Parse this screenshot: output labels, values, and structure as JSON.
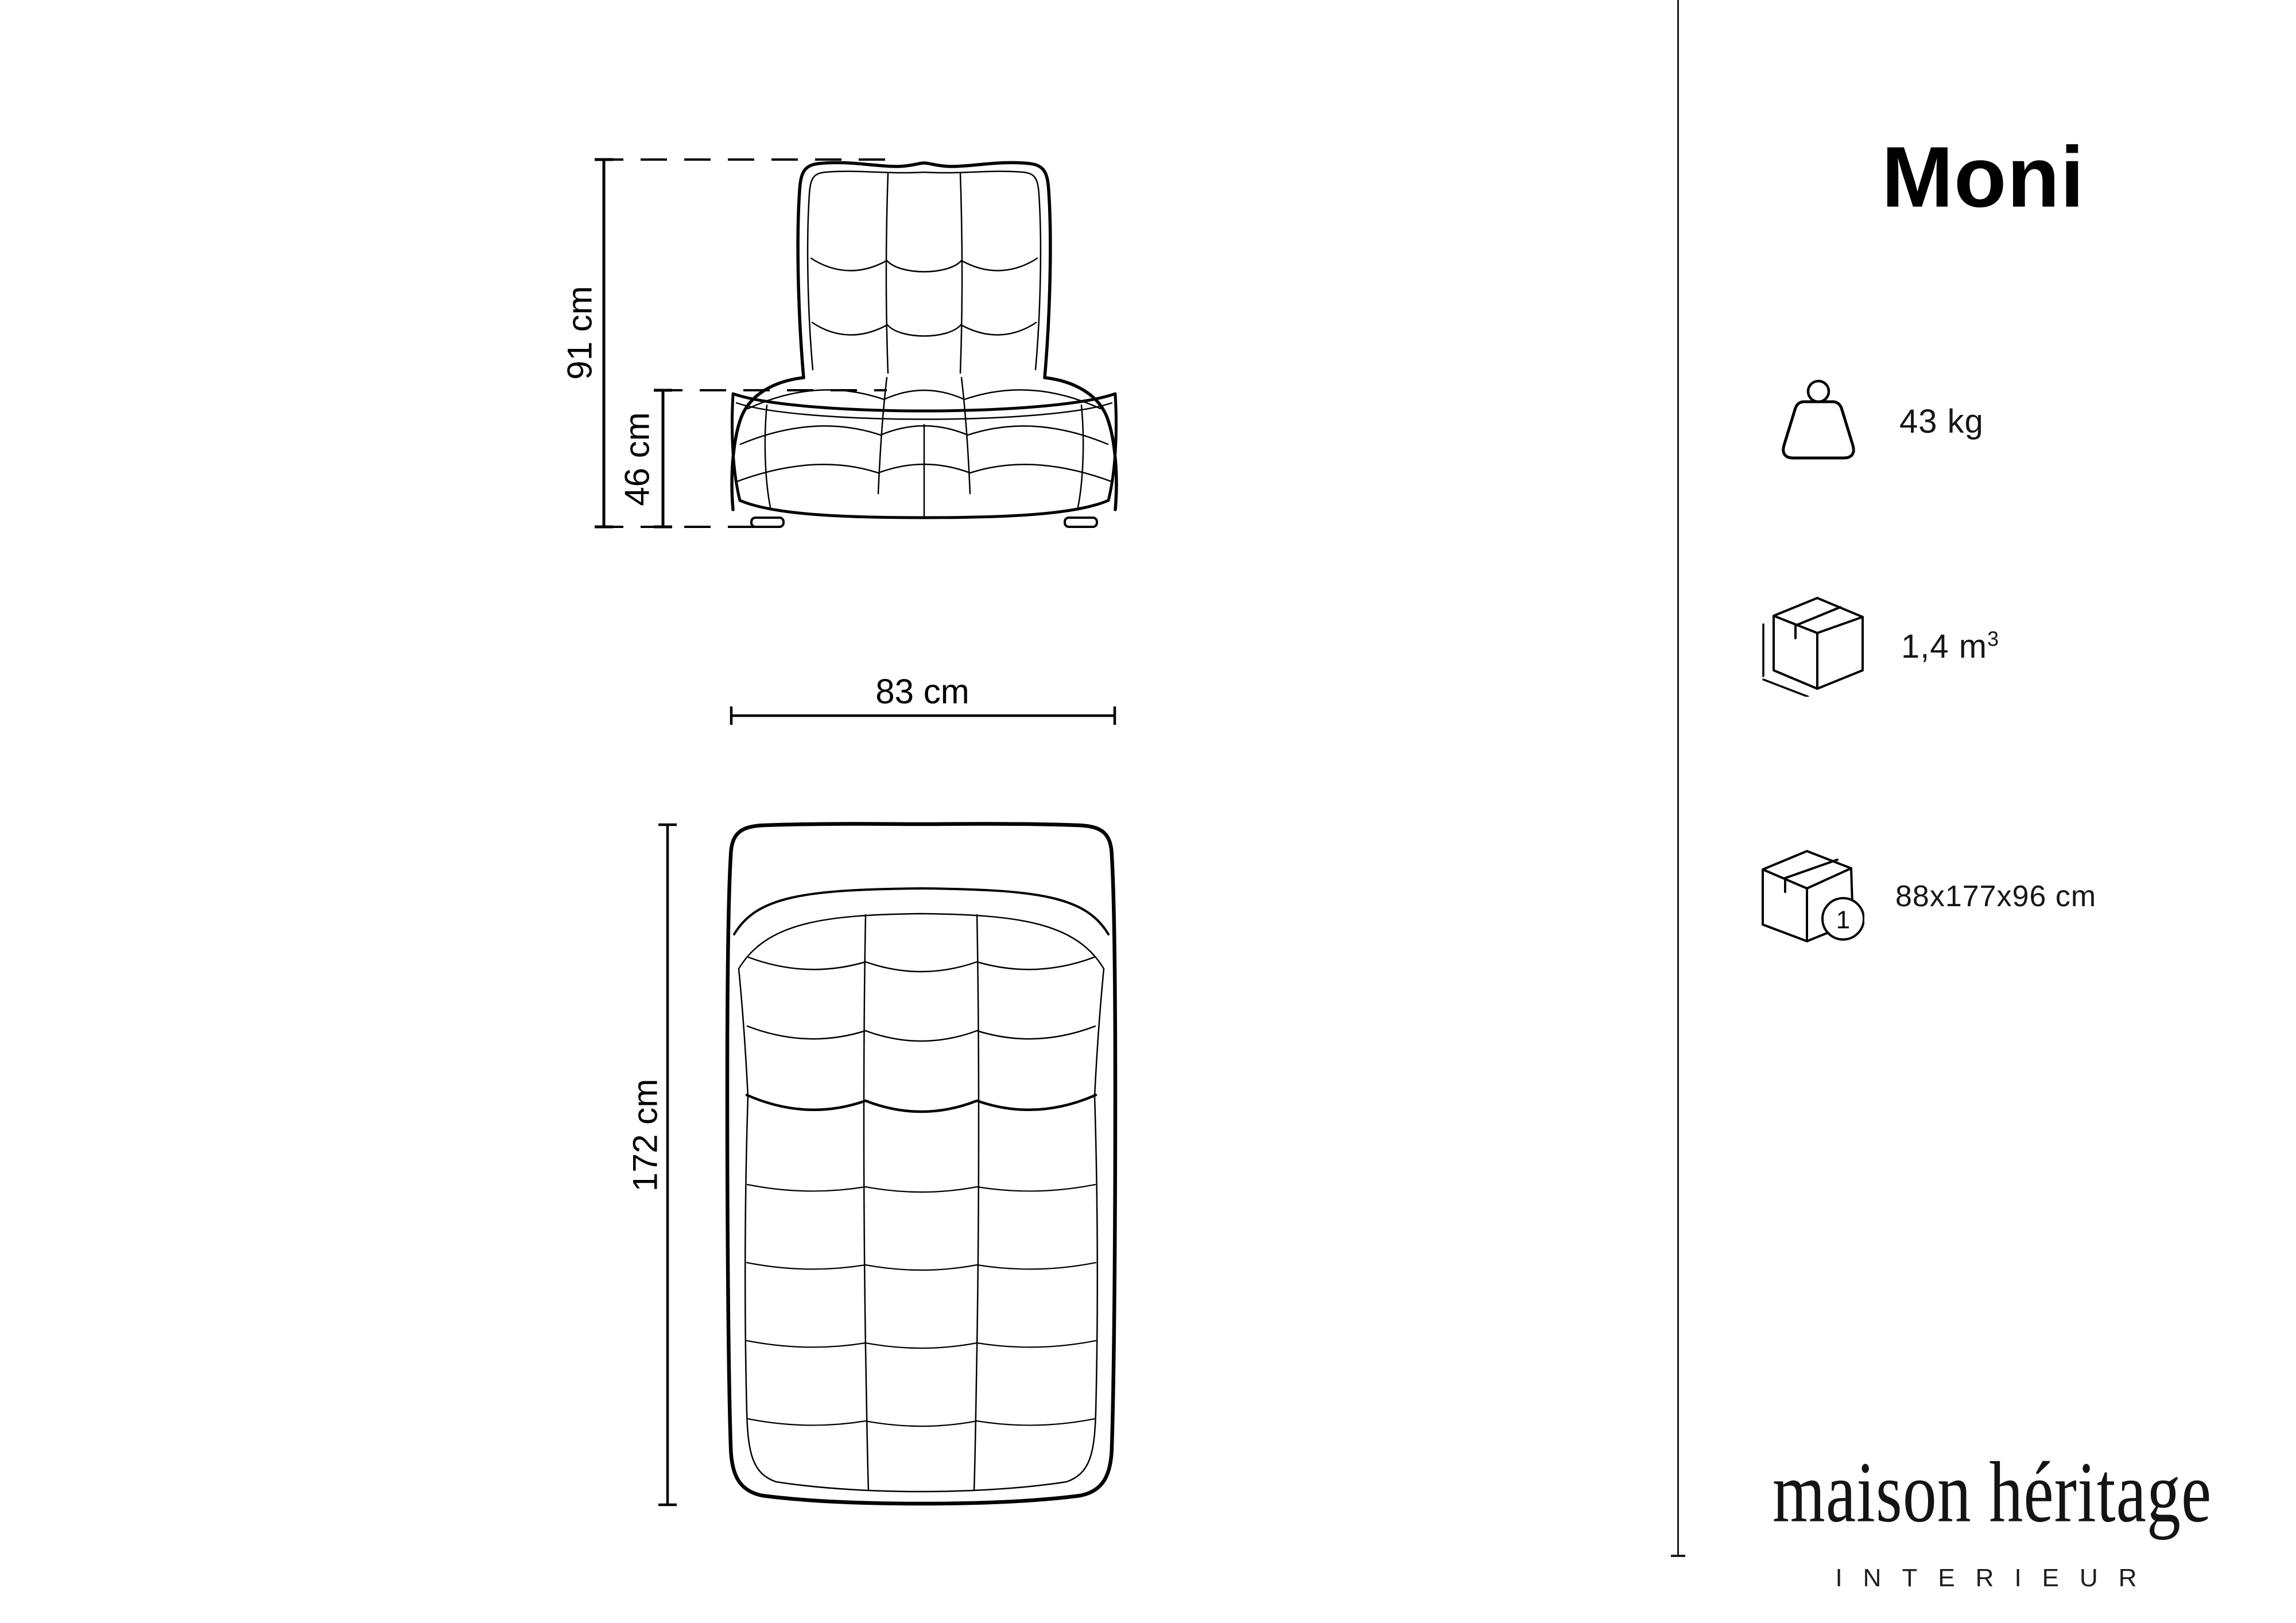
{
  "page": {
    "background": "#ffffff",
    "line_color": "#000000"
  },
  "product": {
    "title": "Moni"
  },
  "specs": {
    "weight": {
      "icon": "weight-icon",
      "value": "43 kg"
    },
    "volume": {
      "icon": "volume-box-icon",
      "value": "1,4 m",
      "sup": "3"
    },
    "package": {
      "icon": "package-box-icon",
      "badge": "1",
      "value": "88x177x96 cm"
    }
  },
  "brand": {
    "name": "maison héritage",
    "subtitle": "INTERIEUR"
  },
  "front_view": {
    "height": "91 cm",
    "seat_height": "46 cm"
  },
  "top_view": {
    "width": "83 cm",
    "depth": "172 cm"
  }
}
